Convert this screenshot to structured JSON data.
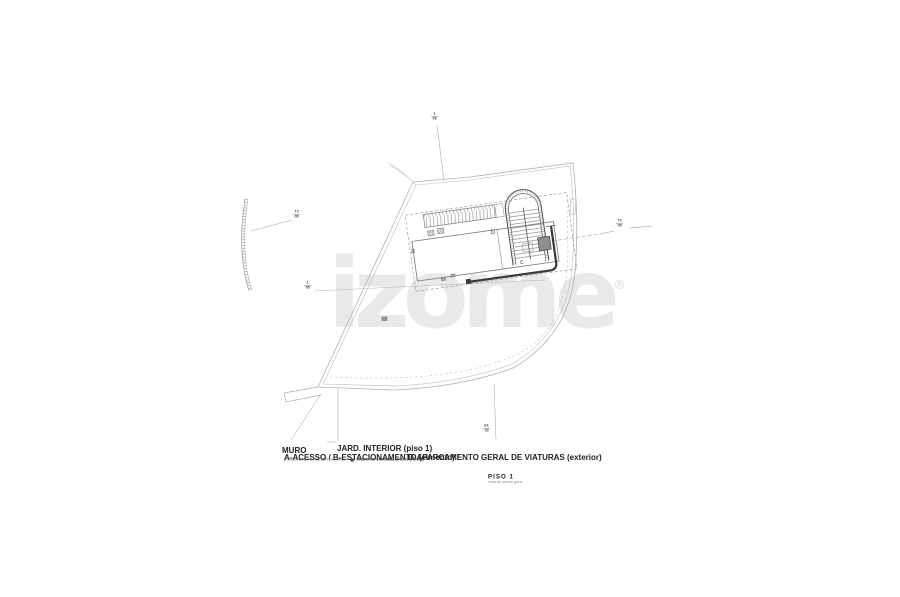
{
  "watermark": {
    "text": "izome",
    "registered": "®"
  },
  "title_block": {
    "title": "PISO 1",
    "subtitle": "vista de planta geral"
  },
  "legend": {
    "line1_left": "A-ACESSO / B-ESTACIONAMENTO (cimento) /",
    "line1_right": "D-APARCAMENTO GERAL DE VIATURAS (exterior)",
    "line2_left": "(C-ESCADAS DE ACESSO (exterior))",
    "line2_right": "ÁREAS IMPERMEABILIZADAS (PISO 1)"
  },
  "callouts": {
    "muro": "MURO",
    "jardim": "JARD. INTERIOR (piso 1)"
  },
  "section_markers": {
    "top": {
      "a": "1",
      "b": "05"
    },
    "left_upper": {
      "a": "T2",
      "b": "05"
    },
    "left_lower": {
      "a": "1",
      "b": "05"
    },
    "right": {
      "a": "T2",
      "b": "05"
    },
    "bottom": {
      "a": "E1",
      "b": "03"
    }
  },
  "micro_labels": {
    "room_a": "a",
    "room_b": "b",
    "stair_c": "c"
  },
  "colors": {
    "background": "#ffffff",
    "site_line": "#b0b0b0",
    "building_line": "#6e6e6e",
    "dark_line": "#3a3a3a",
    "fill_gray": "#8f8f8f",
    "watermark": "#e9e9e9"
  }
}
